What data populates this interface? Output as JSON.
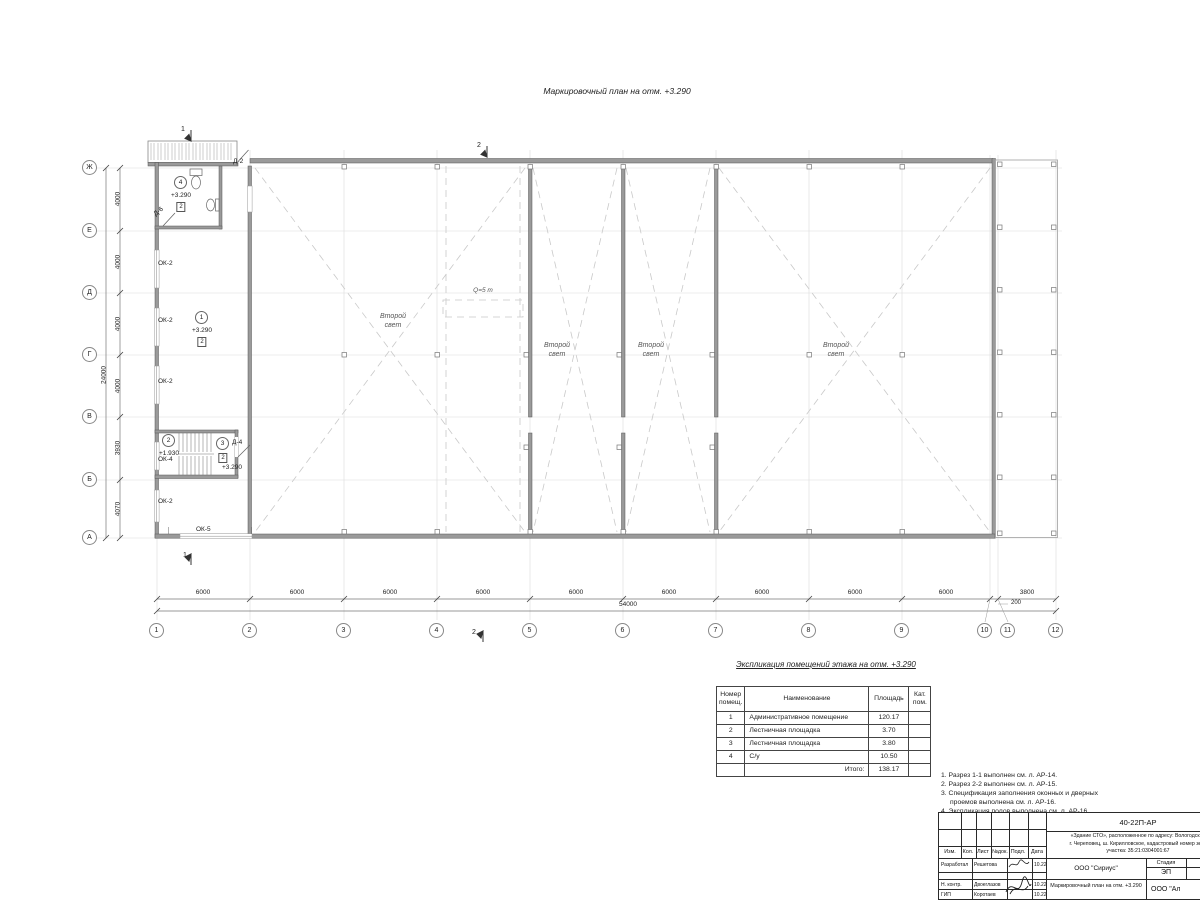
{
  "page": {
    "title": "Маркировочный план на отм. +3.290"
  },
  "plan": {
    "sections": {
      "s1": "1",
      "s2": "2"
    },
    "crane": "Q=5 т",
    "second_light": "Второй свет",
    "columns": {
      "labels": [
        "1",
        "2",
        "3",
        "4",
        "5",
        "6",
        "7",
        "8",
        "9",
        "10",
        "11",
        "12"
      ],
      "dims": [
        "6000",
        "6000",
        "6000",
        "6000",
        "6000",
        "6000",
        "6000",
        "6000",
        "6000",
        "200",
        "3800"
      ],
      "total": "54000"
    },
    "rows": {
      "labels": [
        "Ж",
        "Е",
        "Д",
        "Г",
        "В",
        "Б",
        "А"
      ],
      "dims": [
        "4000",
        "4000",
        "4000",
        "4000",
        "3930",
        "4070"
      ],
      "total": "24000"
    },
    "rooms": [
      {
        "number": "1",
        "elevation": "+3.290",
        "floor": "2"
      },
      {
        "number": "2",
        "elevation": "+1.930"
      },
      {
        "number": "3",
        "elevation": "+3.290",
        "floor": "2"
      },
      {
        "number": "4",
        "elevation": "+3.290",
        "floor": "2"
      }
    ],
    "marks": {
      "ok2": "ОК-2",
      "ok4": "ОК-4",
      "ok5": "ОК-5",
      "d2": "Д-2",
      "d4": "Д-4",
      "d6": "Д-6"
    }
  },
  "explication": {
    "title": "Экспликация помещений этажа на отм. +3.290",
    "columns": [
      "Номер помещ.",
      "Наименование",
      "Площадь",
      "Кат. пом."
    ],
    "rows": [
      {
        "num": "1",
        "name": "Административное помещение",
        "area": "120.17",
        "cat": ""
      },
      {
        "num": "2",
        "name": "Лестничная площадка",
        "area": "3.70",
        "cat": ""
      },
      {
        "num": "3",
        "name": "Лестничная площадка",
        "area": "3.80",
        "cat": ""
      },
      {
        "num": "4",
        "name": "С/у",
        "area": "10.50",
        "cat": ""
      }
    ],
    "total_label": "Итого:",
    "total_value": "138.17"
  },
  "notes": {
    "lines": [
      "1. Разрез 1-1 выполнен см. л. АР-14.",
      "2. Разрез 2-2 выполнен см. л. АР-15.",
      "3. Спецификация заполнения оконных и дверных",
      "проемов выполнена см. л. АР-16.",
      "4. Экспликация полов выполнена см. л. АР-16."
    ]
  },
  "stamp": {
    "doc_number": "40-22П-АР",
    "project_line1": "«Здание СТО», расположенное по адресу: Вологодская",
    "project_line2": "г. Череповец, ш. Кирилловское, кадастровый номер зем.",
    "project_line3": "участка: 35:21:0304001:67",
    "header_cols": [
      "Изм.",
      "Кол.",
      "Лист",
      "№док.",
      "Подл.",
      "Дата"
    ],
    "staff": [
      {
        "role": "Разработал",
        "name": "Решетова",
        "date": "10.22"
      },
      {
        "role": "Н. контр.",
        "name": "Двоеглазов",
        "date": "10.22"
      },
      {
        "role": "ГИП",
        "name": "Коротаев",
        "date": "10.22"
      }
    ],
    "org": "ООО \"Сириус\"",
    "stage_label": "Стадия",
    "sheet_label": "Лист",
    "stage": "ЭП",
    "sheet": "12",
    "drawing_title": "Маркировочный план на отм. +3.290",
    "org2": "ООО \"Ал"
  }
}
